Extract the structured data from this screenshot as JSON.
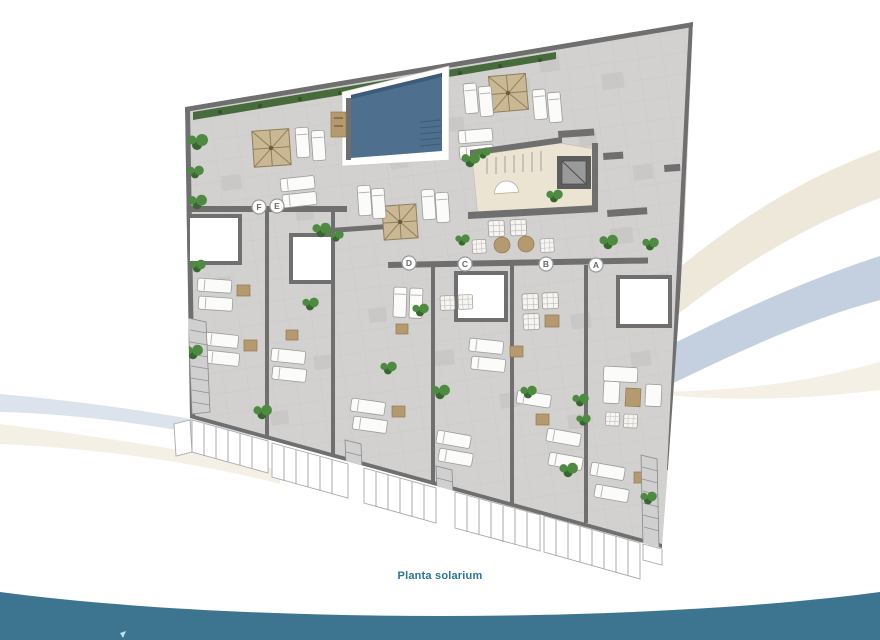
{
  "caption": "Planta solarium",
  "plan": {
    "units": [
      {
        "label": "F"
      },
      {
        "label": "E"
      },
      {
        "label": "D"
      },
      {
        "label": "C"
      },
      {
        "label": "B"
      },
      {
        "label": "A"
      }
    ]
  },
  "icons": {
    "unit_marker": "circled-letter-badge",
    "pool": "swimming-pool",
    "pergola": "pergola-cross-square",
    "sun_lounger": "sun-lounger",
    "plant": "shrub-cluster",
    "stairs": "hatched-stair-run",
    "elevator": "elevator-core",
    "railing": "glass-railing-posts",
    "swoosh": "decorative-curved-band"
  },
  "colors": {
    "floor": "#d3d1cf",
    "floor_patch": "#c3c1bf",
    "wall": "#6f6f6f",
    "pool": "#4e6f8d",
    "pool_dark": "#3c5c78",
    "pergola": "#c9b893",
    "pergola_line": "#8f7f5c",
    "lounge_floor": "#ece4d2",
    "lounger": "#fbfbfa",
    "table_wood": "#b49a6e",
    "plant": "#4f8a43",
    "plant_dark": "#37662f",
    "hedge": "#476b3c",
    "railing": "#ffffff",
    "railing_line": "#a9a9a9",
    "label_ring": "#9a9a9a",
    "label_text": "#6a6a6a",
    "swoosh_cream": "#eee8db",
    "swoosh_blue": "#c4cfdf",
    "swoosh_faint": "#f5f0e6",
    "swoosh_left_blue": "#dde3ed",
    "footer_teal": "#3d7490",
    "caption_text": "#2d7492",
    "logo_accent": "#bfe3ee"
  }
}
